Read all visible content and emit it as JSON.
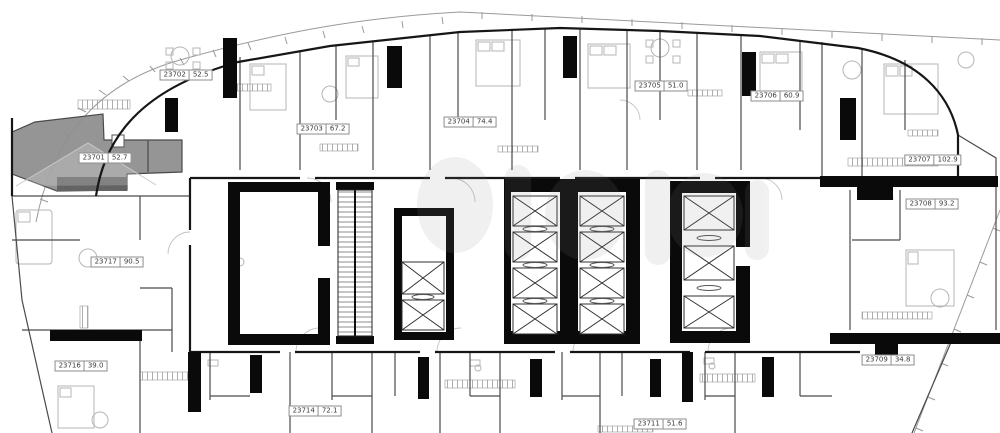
{
  "plan": {
    "type": "apartment-floor-plan",
    "highlighted_unit": "23701",
    "units": [
      {
        "id": "23701",
        "area": "52.7",
        "highlighted": true
      },
      {
        "id": "23702",
        "area": "52.5",
        "highlighted": false
      },
      {
        "id": "23703",
        "area": "67.2",
        "highlighted": false
      },
      {
        "id": "23704",
        "area": "74.4",
        "highlighted": false
      },
      {
        "id": "23705",
        "area": "51.0",
        "highlighted": false
      },
      {
        "id": "23706",
        "area": "60.9",
        "highlighted": false
      },
      {
        "id": "23707",
        "area": "102.9",
        "highlighted": false
      },
      {
        "id": "23708",
        "area": "93.2",
        "highlighted": false
      },
      {
        "id": "23709",
        "area": "34.8",
        "highlighted": false
      },
      {
        "id": "23711",
        "area": "51.6",
        "highlighted": false
      },
      {
        "id": "23714",
        "area": "72.1",
        "highlighted": false
      },
      {
        "id": "23716",
        "area": "39.0",
        "highlighted": false
      },
      {
        "id": "23717",
        "area": "90.5",
        "highlighted": false
      }
    ],
    "colors": {
      "wall": "#0a0a0a",
      "partition": "#4a4a4a",
      "furniture": "#b5b5b5",
      "highlight_fill": "#8e8e8e",
      "site_line": "#9a9a9a",
      "label_border": "#8d8d8d"
    }
  }
}
